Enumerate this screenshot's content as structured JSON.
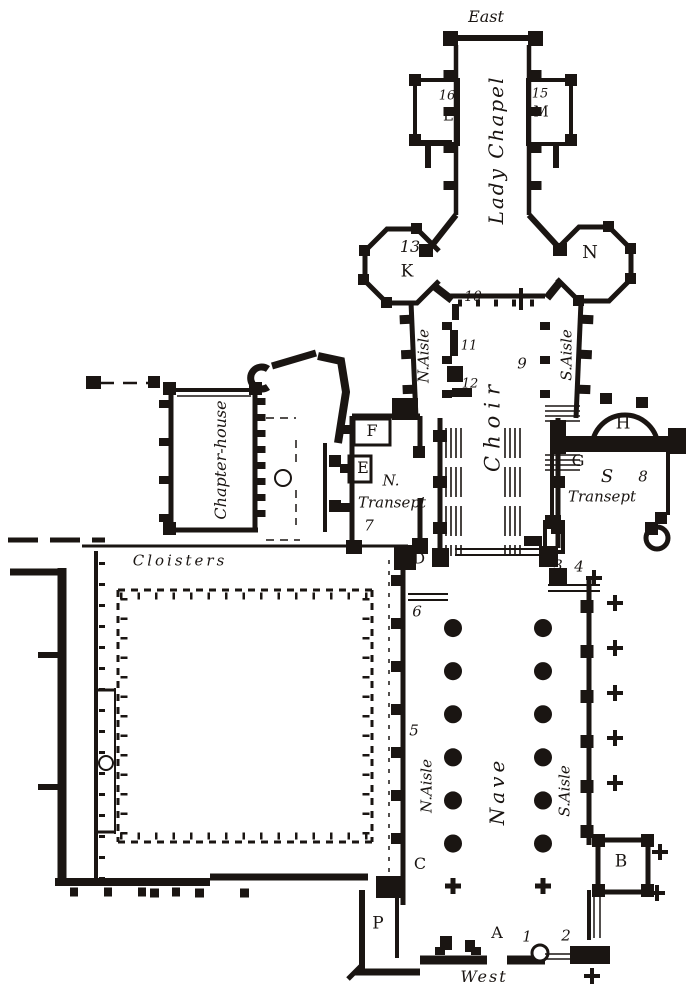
{
  "figure": {
    "type": "architectural-floor-plan",
    "subject": "Engraved ground plan of a cathedral church with cloisters",
    "ink_color": "#1a1512",
    "paper_color": "#ffffff"
  },
  "labels": {
    "east": "East",
    "lady_chapel": "Lady Chapel",
    "num_16": "16",
    "letter_L": "L",
    "num_15": "15",
    "letter_M": "M",
    "num_13": "13",
    "letter_K": "K",
    "letter_N": "N",
    "num_10": "10",
    "n_aisle_east": "N.Aisle",
    "num_11": "11",
    "num_12": "12",
    "num_9": "9",
    "s_aisle_east": "S.Aisle",
    "choir": "Choir",
    "chapter_house": "Chapter-house",
    "letter_F": "F",
    "letter_E": "E",
    "n_transept_line1": "N.",
    "n_transept_line2": "Transept",
    "num_7": "7",
    "letter_H": "H",
    "letter_G": "G",
    "s_transept_s": "S",
    "num_8": "8",
    "s_transept_word": "Transept",
    "cloisters": "Cloisters",
    "letter_D": "D",
    "num_3": "3",
    "num_4": "4",
    "num_6": "6",
    "num_5": "5",
    "n_aisle_nave": "N.Aisle",
    "nave": "Nave",
    "s_aisle_nave": "S.Aisle",
    "letter_C": "C",
    "letter_B": "B",
    "letter_P": "P",
    "letter_A": "A",
    "num_1": "1",
    "num_2": "2",
    "west": "West"
  }
}
